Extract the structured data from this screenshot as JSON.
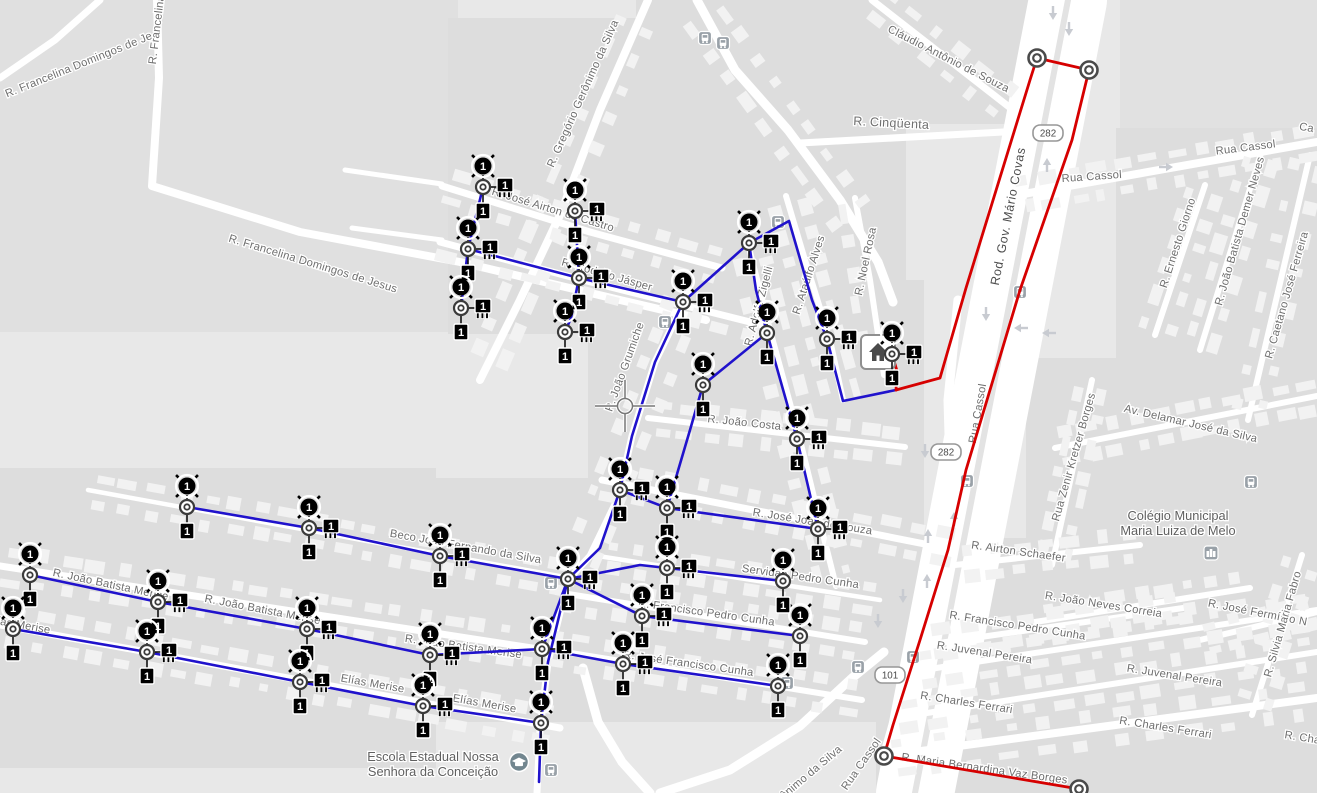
{
  "map": {
    "land_color": "#e8e8e8",
    "road_color": "#ffffff",
    "label_color": "#6e6e6e",
    "feeder_color": "#2012cc",
    "backbone_color": "#d60000",
    "badge_text": "1",
    "crosshair": {
      "x": 625,
      "y": 406
    }
  },
  "street_labels": [
    {
      "t": "R. Francelina Domingos de Je",
      "x": 80,
      "y": 68,
      "r": -22
    },
    {
      "t": "R. Francelina",
      "x": 160,
      "y": 30,
      "r": -83
    },
    {
      "t": "R. Francelina Domingos de Jesus",
      "x": 312,
      "y": 267,
      "r": 17
    },
    {
      "t": "R. Gregório Gerônimo da Silva",
      "x": 586,
      "y": 95,
      "r": -66
    },
    {
      "t": "R. José Airton de Castro",
      "x": 552,
      "y": 213,
      "r": 17
    },
    {
      "t": "R. Rodolfo Jásper",
      "x": 606,
      "y": 278,
      "r": 16
    },
    {
      "t": "R. Cinqüenta",
      "x": 891,
      "y": 127,
      "r": 3,
      "s": 12.5
    },
    {
      "t": "Cláudio Antônio de Souza",
      "x": 947,
      "y": 62,
      "r": 27
    },
    {
      "t": "Rod. Gov. Mário Covas",
      "x": 1012,
      "y": 217,
      "r": -79,
      "c": "hwy"
    },
    {
      "t": "Rua Cassol",
      "x": 1092,
      "y": 180,
      "r": -4
    },
    {
      "t": "Rua Cassol",
      "x": 1246,
      "y": 151,
      "r": -7
    },
    {
      "t": "Rua Cassol",
      "x": 981,
      "y": 414,
      "r": -80
    },
    {
      "t": "Ca",
      "x": 1306,
      "y": 131,
      "r": 10
    },
    {
      "t": "R. Ernesto Giorno",
      "x": 1181,
      "y": 244,
      "r": -72
    },
    {
      "t": "R. João Batista Demer Neves",
      "x": 1243,
      "y": 232,
      "r": -74
    },
    {
      "t": "R. Caetano José Ferreira",
      "x": 1290,
      "y": 296,
      "r": -74
    },
    {
      "t": "Av. Delamar José da Silva",
      "x": 1190,
      "y": 427,
      "r": 13
    },
    {
      "t": "Rua Zenir Kretzer Borges",
      "x": 1077,
      "y": 458,
      "r": -74
    },
    {
      "t": "R. José Fermínio N",
      "x": 1257,
      "y": 616,
      "r": 11
    },
    {
      "t": "R. Airton Schaefer",
      "x": 1018,
      "y": 555,
      "r": 8
    },
    {
      "t": "R. João Neves Correia",
      "x": 1103,
      "y": 608,
      "r": 9
    },
    {
      "t": "R. Francisco Pedro Cunha",
      "x": 1017,
      "y": 629,
      "r": 9
    },
    {
      "t": "R. Juvenal Pereira",
      "x": 984,
      "y": 656,
      "r": 9
    },
    {
      "t": "R. Juvenal Pereira",
      "x": 1174,
      "y": 679,
      "r": 9
    },
    {
      "t": "R. Charles Ferrari",
      "x": 966,
      "y": 706,
      "r": 9
    },
    {
      "t": "R. Charles Ferrari",
      "x": 1165,
      "y": 731,
      "r": 9
    },
    {
      "t": "R. Silvia Maria Fabro",
      "x": 1286,
      "y": 625,
      "r": -74
    },
    {
      "t": "R. Cha",
      "x": 1302,
      "y": 741,
      "r": 9
    },
    {
      "t": "R. Maria Bernardina Vaz Borges",
      "x": 984,
      "y": 772,
      "r": 8
    },
    {
      "t": "R. Noel Rosa",
      "x": 869,
      "y": 262,
      "r": -78
    },
    {
      "t": "R. Ataúlfo Alves",
      "x": 812,
      "y": 276,
      "r": -72
    },
    {
      "t": "R. Adolfo Zigelli",
      "x": 762,
      "y": 307,
      "r": -75
    },
    {
      "t": "R. João Grumiche",
      "x": 628,
      "y": 368,
      "r": -70
    },
    {
      "t": "R. João Costa",
      "x": 744,
      "y": 426,
      "r": 6
    },
    {
      "t": "R. José João de Souza",
      "x": 812,
      "y": 525,
      "r": 9
    },
    {
      "t": "Servidão Pedro Cunha",
      "x": 800,
      "y": 580,
      "r": 8
    },
    {
      "t": "R. Francisco Pedro Cunha",
      "x": 706,
      "y": 616,
      "r": 8
    },
    {
      "t": "R. José Francisco Cunha",
      "x": 688,
      "y": 667,
      "r": 8
    },
    {
      "t": "Beco João Fernando da Silva",
      "x": 465,
      "y": 550,
      "r": 10
    },
    {
      "t": "R. João Batista Merise",
      "x": 110,
      "y": 588,
      "r": 12
    },
    {
      "t": "R. João Batista Merise",
      "x": 262,
      "y": 613,
      "r": 11
    },
    {
      "t": "R. João Batista Merise",
      "x": 463,
      "y": 650,
      "r": 8
    },
    {
      "t": "Elías Merise",
      "x": 18,
      "y": 628,
      "r": 10
    },
    {
      "t": "Elías Merise",
      "x": 372,
      "y": 687,
      "r": 10
    },
    {
      "t": "Elías Merise",
      "x": 484,
      "y": 707,
      "r": 10
    },
    {
      "t": "R. Gerônimo da Silva",
      "x": 800,
      "y": 786,
      "r": -40
    },
    {
      "t": "Rua Cassol",
      "x": 864,
      "y": 766,
      "r": -55
    }
  ],
  "route_shields": [
    {
      "text": "282",
      "x": 1048,
      "y": 133
    },
    {
      "text": "282",
      "x": 946,
      "y": 452
    },
    {
      "text": "101",
      "x": 890,
      "y": 675
    }
  ],
  "pois": [
    {
      "lines": [
        "Colégio Municipal",
        "Maria Luiza de Melo"
      ],
      "x": 1178,
      "y": 520,
      "icon": "school-building-icon",
      "ix": 1211,
      "iy": 553
    },
    {
      "lines": [
        "Escola Estadual Nossa",
        "Senhora da Conceição"
      ],
      "x": 433,
      "y": 761,
      "icon": "graduation-cap-icon",
      "ix": 519,
      "iy": 762
    }
  ],
  "transit_stops": [
    [
      705,
      38
    ],
    [
      723,
      43
    ],
    [
      778,
      222
    ],
    [
      665,
      322
    ],
    [
      1020,
      292
    ],
    [
      967,
      481
    ],
    [
      1251,
      482
    ],
    [
      551,
      583
    ],
    [
      913,
      657
    ],
    [
      858,
      667
    ],
    [
      787,
      683
    ],
    [
      551,
      770
    ]
  ],
  "lane_arrows": [
    [
      1053,
      12,
      180
    ],
    [
      1069,
      28,
      180
    ],
    [
      1047,
      166,
      0
    ],
    [
      986,
      313,
      180
    ],
    [
      1022,
      328,
      270
    ],
    [
      1050,
      333,
      270
    ],
    [
      925,
      450,
      180
    ],
    [
      954,
      520,
      0
    ],
    [
      928,
      537,
      0
    ],
    [
      903,
      595,
      180
    ],
    [
      927,
      582,
      0
    ],
    [
      878,
      620,
      180
    ],
    [
      1165,
      167,
      90
    ]
  ],
  "network": {
    "badge_text": "1",
    "nodes": [
      {
        "x": 483,
        "y": 187,
        "load": 1,
        "xfmr": 1,
        "tag": 1
      },
      {
        "x": 468,
        "y": 249,
        "load": 1,
        "xfmr": 1,
        "tag": 1
      },
      {
        "x": 461,
        "y": 308,
        "load": 1,
        "xfmr": 1,
        "tag": 1
      },
      {
        "x": 575,
        "y": 211,
        "load": 1,
        "xfmr": 1,
        "tag": 1
      },
      {
        "x": 579,
        "y": 278,
        "load": 1,
        "xfmr": 1,
        "tag": 1
      },
      {
        "x": 565,
        "y": 332,
        "load": 1,
        "xfmr": 1,
        "tag": 1
      },
      {
        "x": 683,
        "y": 302,
        "load": 1,
        "xfmr": 1,
        "tag": 1
      },
      {
        "x": 749,
        "y": 243,
        "load": 1,
        "xfmr": 1,
        "tag": 1
      },
      {
        "x": 827,
        "y": 339,
        "load": 1,
        "xfmr": 1,
        "tag": 1
      },
      {
        "x": 767,
        "y": 333,
        "load": 1,
        "tag": 1
      },
      {
        "x": 797,
        "y": 439,
        "load": 1,
        "xfmr": 1,
        "tag": 1
      },
      {
        "x": 818,
        "y": 529,
        "load": 1,
        "xfmr": 1,
        "tag": 1
      },
      {
        "x": 703,
        "y": 385,
        "load": 1,
        "tag": 1
      },
      {
        "x": 620,
        "y": 490,
        "load": 1,
        "xfmr": 1,
        "tag": 1
      },
      {
        "x": 667,
        "y": 508,
        "load": 1,
        "xfmr": 1,
        "tag": 1
      },
      {
        "x": 568,
        "y": 579,
        "load": 1,
        "xfmr": 1,
        "tag": 1
      },
      {
        "x": 642,
        "y": 616,
        "load": 1,
        "xfmr": 1,
        "tag": 1
      },
      {
        "x": 800,
        "y": 636,
        "load": 1,
        "tag": 1
      },
      {
        "x": 667,
        "y": 568,
        "load": 1,
        "xfmr": 1,
        "tag": 1
      },
      {
        "x": 783,
        "y": 581,
        "load": 1,
        "tag": 1
      },
      {
        "x": 187,
        "y": 507,
        "load": 1,
        "tag": 1
      },
      {
        "x": 309,
        "y": 528,
        "load": 1,
        "xfmr": 1,
        "tag": 1
      },
      {
        "x": 440,
        "y": 556,
        "load": 1,
        "xfmr": 1,
        "tag": 1
      },
      {
        "x": 30,
        "y": 575,
        "load": 1,
        "tag": 1
      },
      {
        "x": 158,
        "y": 602,
        "load": 1,
        "xfmr": 1,
        "tag": 1
      },
      {
        "x": 307,
        "y": 629,
        "load": 1,
        "xfmr": 1,
        "tag": 1
      },
      {
        "x": 430,
        "y": 655,
        "load": 1,
        "xfmr": 1,
        "tag": 1
      },
      {
        "x": 542,
        "y": 649,
        "load": 1,
        "xfmr": 1,
        "tag": 1
      },
      {
        "x": 13,
        "y": 629,
        "load": 1,
        "tag": 1
      },
      {
        "x": 147,
        "y": 652,
        "load": 1,
        "xfmr": 1,
        "tag": 1
      },
      {
        "x": 300,
        "y": 682,
        "load": 1,
        "xfmr": 1,
        "tag": 1
      },
      {
        "x": 423,
        "y": 706,
        "load": 1,
        "xfmr": 1,
        "tag": 1
      },
      {
        "x": 541,
        "y": 723,
        "load": 1,
        "tag": 1
      },
      {
        "x": 623,
        "y": 664,
        "load": 1,
        "xfmr": 1,
        "tag": 1
      },
      {
        "x": 778,
        "y": 686,
        "load": 1,
        "tag": 1
      },
      {
        "x": 892,
        "y": 354,
        "load": 1,
        "xfmr": 1,
        "tag": 1,
        "house": 1
      },
      {
        "x": 1037,
        "y": 58,
        "kind": "ring"
      },
      {
        "x": 1089,
        "y": 70,
        "kind": "ring"
      },
      {
        "x": 884,
        "y": 756,
        "kind": "ring"
      },
      {
        "x": 1079,
        "y": 789,
        "kind": "ring"
      }
    ],
    "blue_edges": [
      [
        [
          483,
          187
        ],
        [
          468,
          249
        ],
        [
          461,
          308
        ]
      ],
      [
        [
          468,
          249
        ],
        [
          579,
          278
        ],
        [
          683,
          302
        ]
      ],
      [
        [
          575,
          211
        ],
        [
          579,
          278
        ],
        [
          571,
          318
        ],
        [
          565,
          332
        ]
      ],
      [
        [
          683,
          302
        ],
        [
          749,
          243
        ]
      ],
      [
        [
          749,
          243
        ],
        [
          789,
          221
        ],
        [
          812,
          300
        ],
        [
          827,
          339
        ],
        [
          843,
          401
        ],
        [
          896,
          390
        ]
      ],
      [
        [
          749,
          243
        ],
        [
          756,
          290
        ],
        [
          767,
          333
        ]
      ],
      [
        [
          767,
          333
        ],
        [
          797,
          439
        ],
        [
          818,
          529
        ]
      ],
      [
        [
          767,
          333
        ],
        [
          703,
          385
        ],
        [
          690,
          430
        ],
        [
          667,
          508
        ]
      ],
      [
        [
          683,
          302
        ],
        [
          655,
          362
        ],
        [
          632,
          436
        ],
        [
          620,
          490
        ]
      ],
      [
        [
          620,
          490
        ],
        [
          667,
          508
        ],
        [
          818,
          529
        ]
      ],
      [
        [
          620,
          490
        ],
        [
          600,
          548
        ],
        [
          568,
          579
        ]
      ],
      [
        [
          568,
          579
        ],
        [
          440,
          556
        ],
        [
          309,
          528
        ],
        [
          187,
          507
        ]
      ],
      [
        [
          568,
          579
        ],
        [
          640,
          565
        ],
        [
          667,
          568
        ],
        [
          783,
          581
        ]
      ],
      [
        [
          568,
          579
        ],
        [
          642,
          616
        ],
        [
          800,
          636
        ]
      ],
      [
        [
          568,
          579
        ],
        [
          548,
          662
        ],
        [
          541,
          723
        ],
        [
          539,
          782
        ]
      ],
      [
        [
          30,
          575
        ],
        [
          158,
          602
        ],
        [
          307,
          629
        ],
        [
          430,
          655
        ],
        [
          542,
          649
        ]
      ],
      [
        [
          542,
          649
        ],
        [
          568,
          579
        ]
      ],
      [
        [
          542,
          649
        ],
        [
          623,
          664
        ],
        [
          778,
          686
        ]
      ],
      [
        [
          13,
          629
        ],
        [
          147,
          652
        ],
        [
          300,
          682
        ],
        [
          423,
          706
        ],
        [
          541,
          723
        ]
      ]
    ],
    "red_edges": [
      [
        [
          892,
          354
        ],
        [
          897,
          371
        ],
        [
          896,
          390
        ]
      ],
      [
        [
          896,
          390
        ],
        [
          940,
          378
        ],
        [
          966,
          288
        ],
        [
          1030,
          80
        ],
        [
          1037,
          58
        ]
      ],
      [
        [
          1037,
          58
        ],
        [
          1089,
          70
        ]
      ],
      [
        [
          1089,
          70
        ],
        [
          1072,
          140
        ],
        [
          1020,
          290
        ],
        [
          966,
          470
        ],
        [
          948,
          550
        ],
        [
          920,
          640
        ],
        [
          893,
          725
        ],
        [
          884,
          756
        ]
      ],
      [
        [
          884,
          756
        ],
        [
          1079,
          789
        ]
      ]
    ]
  }
}
